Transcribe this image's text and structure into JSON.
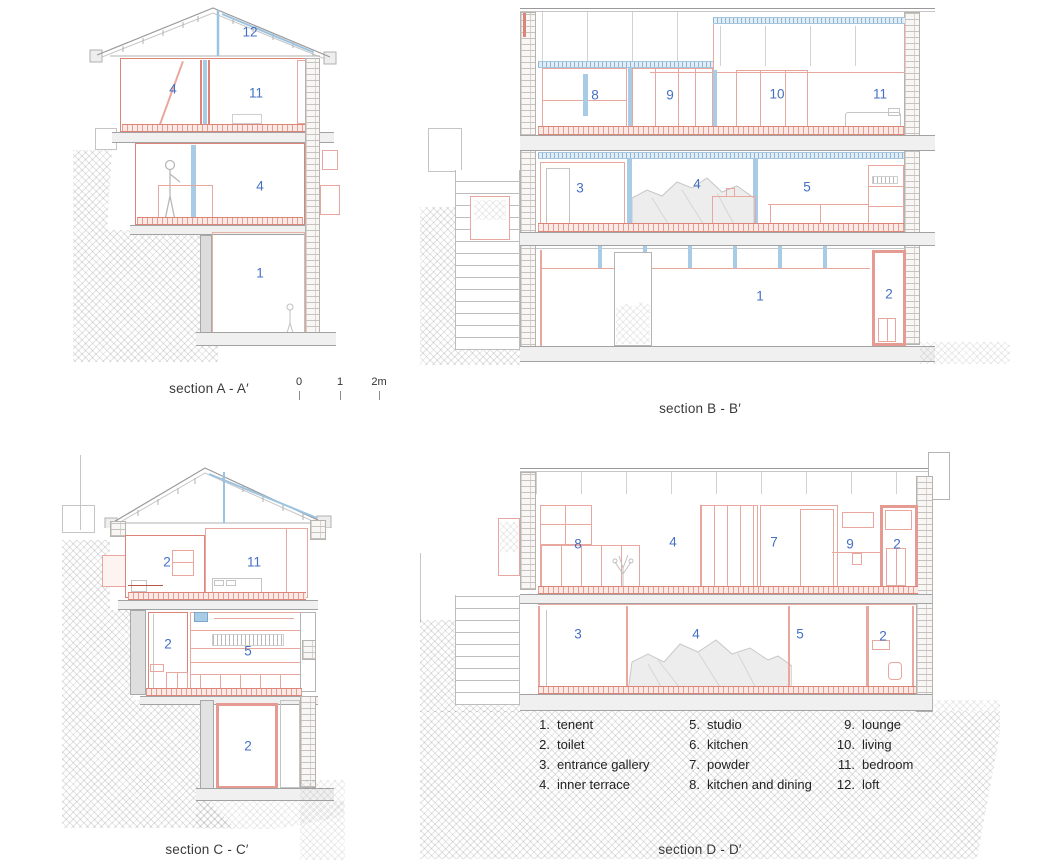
{
  "colors": {
    "wall_red": "#dc8478",
    "wall_red_light": "#e8a89f",
    "insulation_blue": "#a9cce6",
    "number_blue": "#4470c4",
    "line_gray": "#9a9a9a"
  },
  "sections": {
    "A": {
      "label": "section A - A′",
      "rooms": [
        "12",
        "4",
        "11",
        "4",
        "1"
      ]
    },
    "B": {
      "label": "section B - B′",
      "rooms": [
        "8",
        "9",
        "10",
        "11",
        "3",
        "4",
        "5",
        "1",
        "2"
      ]
    },
    "C": {
      "label": "section C - C′",
      "rooms": [
        "2",
        "11",
        "2",
        "5",
        "2"
      ]
    },
    "D": {
      "label": "section D - D′",
      "rooms": [
        "8",
        "4",
        "7",
        "9",
        "2",
        "3",
        "4",
        "5",
        "2"
      ]
    }
  },
  "scale_bar": {
    "ticks": [
      "0",
      "1",
      "2m"
    ]
  },
  "legend": {
    "items": [
      {
        "num": "1.",
        "label": "tenent"
      },
      {
        "num": "2.",
        "label": "toilet"
      },
      {
        "num": "3.",
        "label": "entrance gallery"
      },
      {
        "num": "4.",
        "label": "inner terrace"
      },
      {
        "num": "5.",
        "label": "studio"
      },
      {
        "num": "6.",
        "label": "kitchen"
      },
      {
        "num": "7.",
        "label": "powder"
      },
      {
        "num": "8.",
        "label": "kitchen and dining"
      },
      {
        "num": "9.",
        "label": "lounge"
      },
      {
        "num": "10.",
        "label": "living"
      },
      {
        "num": "11.",
        "label": "bedroom"
      },
      {
        "num": "12.",
        "label": "loft"
      }
    ]
  }
}
